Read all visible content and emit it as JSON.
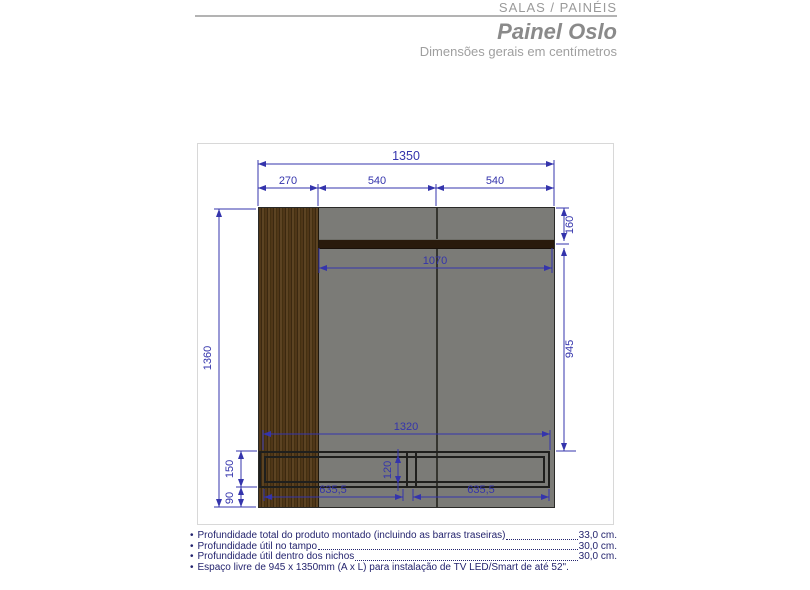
{
  "header": {
    "category": "SALAS / PAINÉIS",
    "title": "Painel Oslo",
    "subtitle": "Dimensões gerais em centímetros"
  },
  "drawing": {
    "dimensions": {
      "total_width": "1350",
      "wood_strip_width": "270",
      "panel_section_left": "540",
      "panel_section_right": "540",
      "total_height": "1360",
      "top_band_height": "160",
      "tv_space_height": "945",
      "shelf_width": "1070",
      "rack_width": "1320",
      "rack_height": "150",
      "rack_inner_height": "120",
      "bottom_gap": "90",
      "niche_left_width": "635,5",
      "niche_right_width": "635,5"
    }
  },
  "specs": {
    "items": [
      {
        "label": "Profundidade total do produto montado (incluindo as barras traseiras)",
        "value": "33,0 cm."
      },
      {
        "label": "Profundidade útil no tampo",
        "value": "30,0 cm."
      },
      {
        "label": "Profundidade útil dentro dos nichos ",
        "value": "30,0 cm."
      },
      {
        "label": "Espaço livre de 945 x 1350mm (A x L) para instalação de TV LED/Smart de até 52\".",
        "value": ""
      }
    ]
  },
  "colors": {
    "dimension_accent": "#3434ac",
    "spec_text": "#24246e",
    "panel_gray": "#7b7b77",
    "wood_brown": "#503718",
    "header_gray": "#9a9a9a"
  }
}
